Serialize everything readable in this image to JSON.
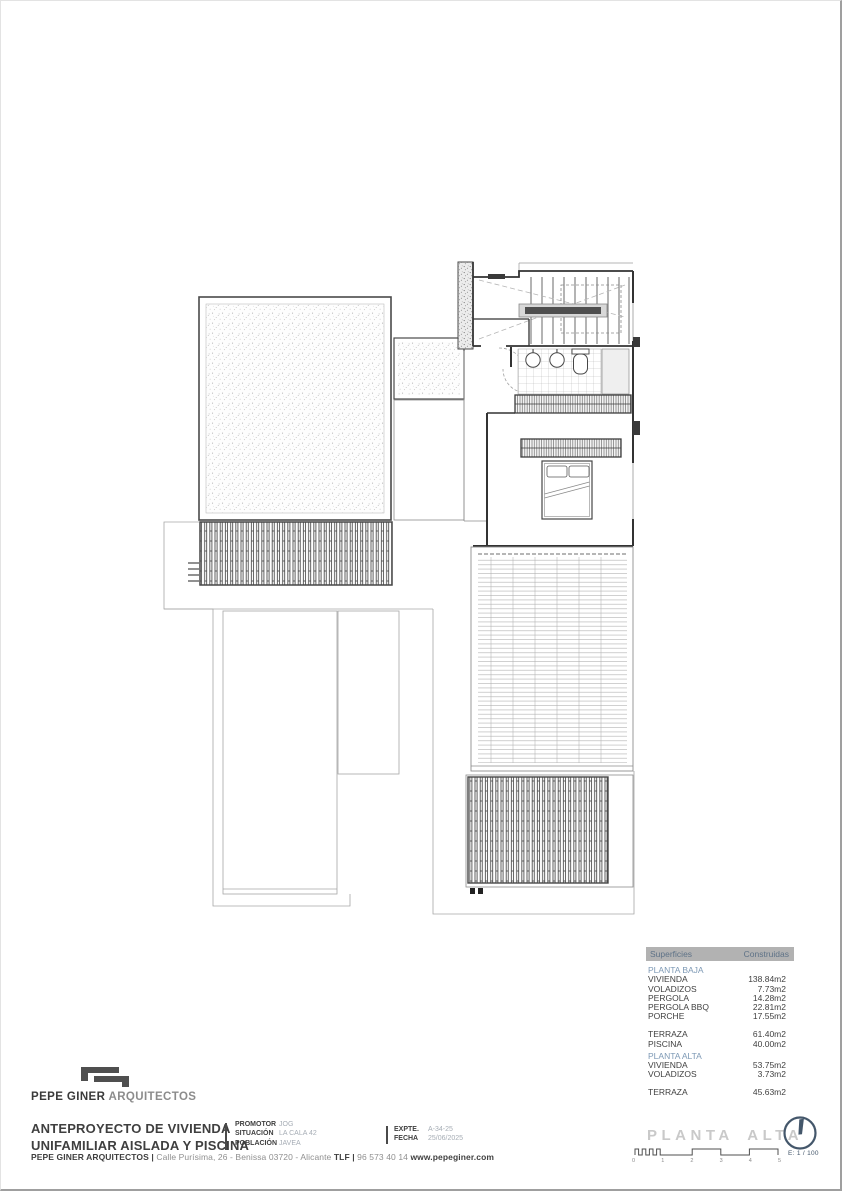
{
  "page": {
    "sheet_label": "PLANTA ALTA"
  },
  "brand": {
    "logo_strong": "PEPE GINER",
    "logo_light": "ARQUITECTOS"
  },
  "project": {
    "title_line1": "ANTEPROYECTO DE VIVIENDA",
    "title_line2": "UNIFAMILIAR AISLADA Y PISCINA",
    "info_fields": [
      {
        "label": "PROMOTOR",
        "value": "JOG"
      },
      {
        "label": "SITUACIÓN",
        "value": "LA CALA 42"
      },
      {
        "label": "POBLACIÓN",
        "value": "JAVEA"
      }
    ],
    "file_fields": [
      {
        "label": "EXPTE.",
        "value": "A-34-25"
      },
      {
        "label": "FECHA",
        "value": "25/06/2025"
      }
    ]
  },
  "footer_segments": [
    {
      "text": "PEPE GINER ARQUITECTOS",
      "bold": true
    },
    {
      "text": " | ",
      "bold": true
    },
    {
      "text": "Calle Purísima, 26 - Benissa 03720 - Alicante ",
      "bold": false
    },
    {
      "text": "TLF",
      "bold": true
    },
    {
      "text": " | ",
      "bold": true
    },
    {
      "text": "96 573 40 14 ",
      "bold": false
    },
    {
      "text": "www.pepeginer.com",
      "bold": true
    }
  ],
  "scale": {
    "label": "E: 1 / 100",
    "ticks": [
      "0",
      "1",
      "2",
      "3",
      "4",
      "5"
    ]
  },
  "areas_table": {
    "col_surface": "Superficies",
    "col_built": "Construidas",
    "rows": [
      {
        "type": "section",
        "label": "PLANTA BAJA"
      },
      {
        "type": "item",
        "label": "VIVIENDA",
        "value": "138.84m2"
      },
      {
        "type": "item",
        "label": "VOLADIZOS",
        "value": "7.73m2"
      },
      {
        "type": "item",
        "label": "PERGOLA",
        "value": "14.28m2"
      },
      {
        "type": "item",
        "label": "PERGOLA BBQ",
        "value": "22.81m2"
      },
      {
        "type": "item",
        "label": "PORCHE",
        "value": "17.55m2"
      },
      {
        "type": "gap"
      },
      {
        "type": "item",
        "label": "TERRAZA",
        "value": "61.40m2"
      },
      {
        "type": "item",
        "label": "PISCINA",
        "value": "40.00m2"
      },
      {
        "type": "section",
        "label": "PLANTA ALTA"
      },
      {
        "type": "item",
        "label": "VIVIENDA",
        "value": "53.75m2"
      },
      {
        "type": "item",
        "label": "VOLADIZOS",
        "value": "3.73m2"
      },
      {
        "type": "gap"
      },
      {
        "type": "item",
        "label": "TERRAZA",
        "value": "45.63m2"
      }
    ]
  },
  "icons": {
    "north_arrow": "north-arrow-icon",
    "logo_mark": "pepe-giner-logo-icon"
  },
  "colors": {
    "accent_slate": "#44576b",
    "table_header_bg": "#b2b2b2",
    "table_header_text": "#5e7287",
    "section_title_blue": "#7d99b5",
    "sheet_label_gray": "#c9c9c9",
    "ink": "#3f3f3f",
    "muted_value": "#a6adb5"
  }
}
